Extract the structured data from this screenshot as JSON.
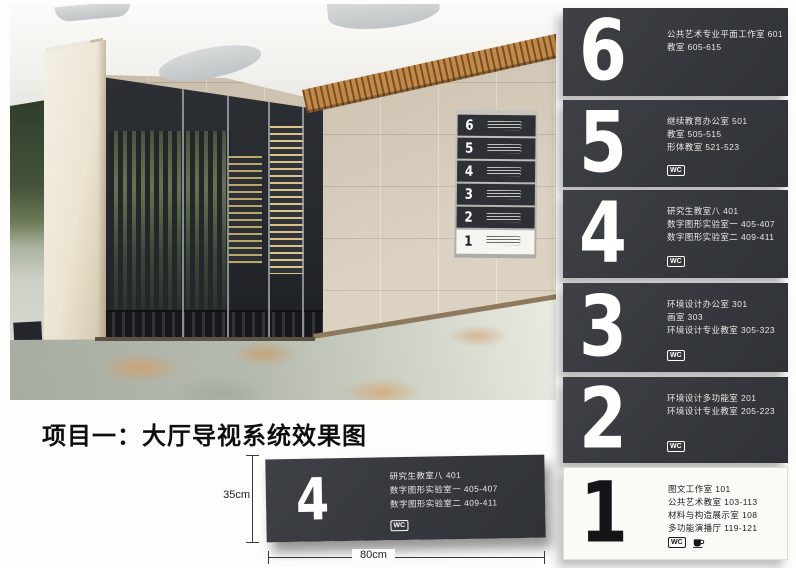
{
  "page": {
    "title": "项目一：大厅导视系统效果图"
  },
  "labels": {
    "wc": "WC"
  },
  "colors": {
    "sign_dark": "#35383d",
    "sign_light": "#fbfaf6",
    "wood": "#c08a4a",
    "tile": "#d6cab7",
    "floor": "#b6bbb0"
  },
  "photo": {
    "directory_floors": [
      "6",
      "5",
      "4",
      "3",
      "2",
      "1"
    ]
  },
  "signs": [
    {
      "number": "6",
      "theme": "dark",
      "lines": [
        "公共艺术专业平面工作室 601",
        "教室 605-615"
      ]
    },
    {
      "number": "5",
      "theme": "dark",
      "lines": [
        "继续教育办公室 501",
        "教室 505-515",
        "形体教室 521-523"
      ]
    },
    {
      "number": "4",
      "theme": "dark",
      "lines": [
        "研究生教室八 401",
        "数字图形实验室一 405-407",
        "数字图形实验室二 409-411"
      ]
    },
    {
      "number": "3",
      "theme": "dark",
      "lines": [
        "环境设计办公室 301",
        "画室 303",
        "环境设计专业教室 305-323"
      ]
    },
    {
      "number": "2",
      "theme": "dark",
      "lines": [
        "环境设计多功能室 201",
        "环境设计专业教室 205-223"
      ]
    },
    {
      "number": "1",
      "theme": "light",
      "lines": [
        "图文工作室 101",
        "公共艺术教室 103-113",
        "材料与构造展示室 108",
        "多功能演播厅 119-121"
      ]
    }
  ],
  "detail_sign": {
    "number": "4",
    "lines": [
      "研究生教室八 401",
      "数字图形实验室一 405-407",
      "数字图形实验室二 409-411"
    ],
    "height_label": "35cm",
    "width_label": "80cm"
  }
}
